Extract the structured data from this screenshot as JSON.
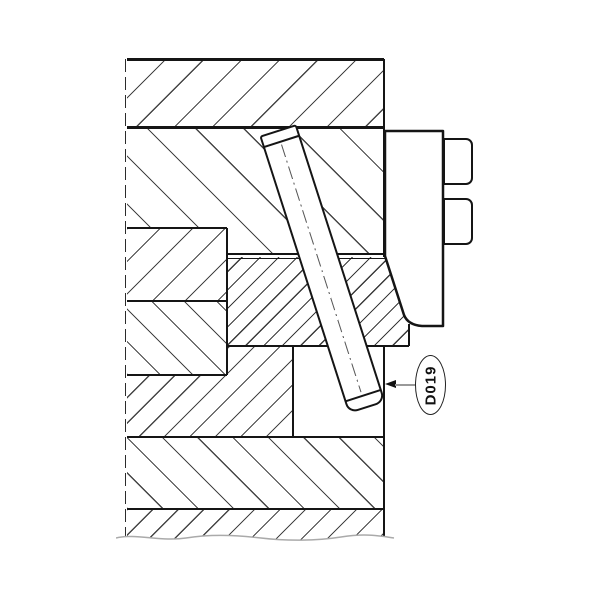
{
  "drawing": {
    "title": "mold-section-with-angled-ejector-pin",
    "callout": {
      "label": "D019",
      "arrow_direction": "left",
      "text_rotation_deg": -90
    },
    "colors": {
      "background": "#ffffff",
      "outline": "#151515",
      "hatch": "#444444",
      "leader_line": "#999999",
      "break_line": "#aaaaaa"
    },
    "features": {
      "regions": [
        "top-plate",
        "upper-backing-plate",
        "insert-block-upper",
        "insert-block-lower",
        "center-wear-plate",
        "support-block",
        "base-plate",
        "lower-break-plate",
        "side-clamp",
        "clamp-bolts",
        "angled-pin",
        "pin-pocket"
      ],
      "break_line_style": "freehand-wavy",
      "left_edge_style": "dashed-break-line"
    }
  }
}
